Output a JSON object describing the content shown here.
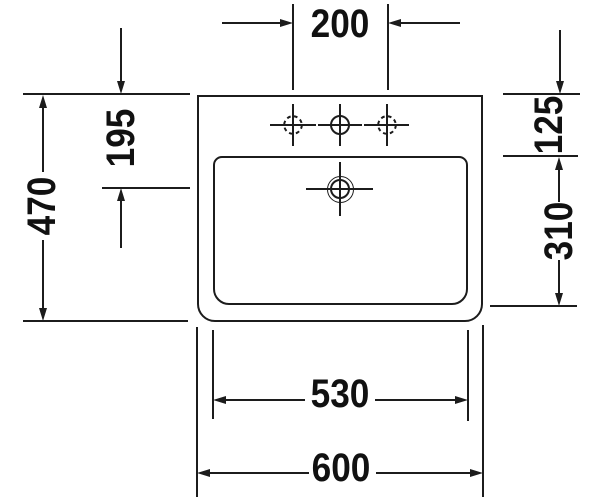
{
  "dimensions": {
    "tap_hole_spacing": "200",
    "overall_depth": "470",
    "rim_to_overflow": "195",
    "rim_to_bowl": "125",
    "bowl_depth": "310",
    "bowl_width": "530",
    "overall_width": "600"
  },
  "colors": {
    "line": "#1c1c1c",
    "background": "#ffffff"
  }
}
